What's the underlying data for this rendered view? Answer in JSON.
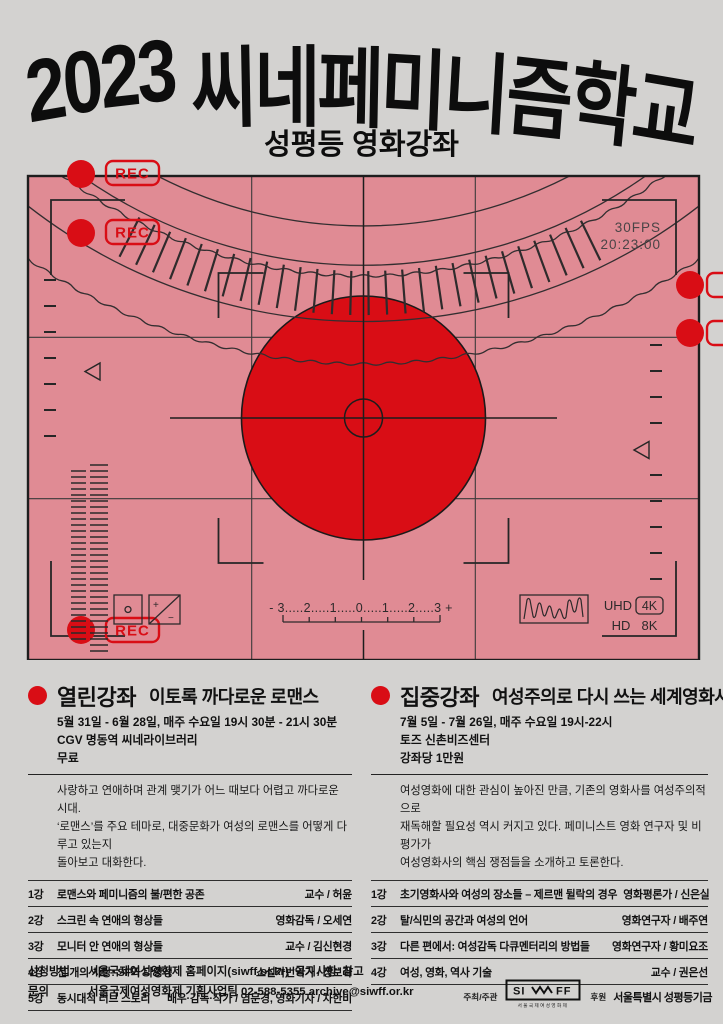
{
  "poster": {
    "title": "2023 씨네페미니즘학교",
    "subtitle": "성평등 영화강좌"
  },
  "viewfinder": {
    "rec_label": "REC",
    "fps": "30FPS",
    "timecode": "20:23:00",
    "scale_text": "- 3.....2.....1.....0.....1.....2.....3 +",
    "uhd_label": "UHD",
    "fourk_label": "4K",
    "hd_label": "HD",
    "eightk_label": "8K",
    "exposure_plus": "+",
    "exposure_minus": "−",
    "accent_red": "#d90d15",
    "panel_pink": "#e08b94"
  },
  "sections": [
    {
      "type": "열린강좌",
      "title": "이토록 까다로운 로맨스",
      "details": [
        "5월 31일 - 6월 28일, 매주 수요일 19시 30분 - 21시 30분",
        "CGV 명동역 씨네라이브러리",
        "무료"
      ],
      "description": "사랑하고 연애하며 관계 맺기가 어느 때보다 어렵고 까다로운 시대.\n‘로맨스’를 주요 테마로, 대중문화가 여성의 로맨스를 어떻게 다루고 있는지\n돌아보고 대화한다.",
      "lectures": [
        {
          "no": "1강",
          "title": "로맨스와 페미니즘의 불/편한 공존",
          "speaker": "교수 / 허윤"
        },
        {
          "no": "2강",
          "title": "스크린 속 연애의 형상들",
          "speaker": "영화감독 / 오세연"
        },
        {
          "no": "3강",
          "title": "모니터 안 연애의 형상들",
          "speaker": "교수 / 김신현경"
        },
        {
          "no": "4강",
          "title": "천 개의 사랑: SF와 다양성",
          "speaker": "소설가번역가 / 정보라"
        },
        {
          "no": "5강",
          "title": "동시대적 러브 스토리",
          "speaker": "배우·감독·작가 / 염문경, 영화기자 / 차한비"
        }
      ]
    },
    {
      "type": "집중강좌",
      "title": "여성주의로 다시 쓰는 세계영화사",
      "details": [
        "7월 5일 - 7월 26일, 매주 수요일 19시-22시",
        "토즈 신촌비즈센터",
        "강좌당 1만원"
      ],
      "description": "여성영화에 대한 관심이 높아진 만큼, 기존의 영화사를 여성주의적으로\n재독해할 필요성 역시 커지고 있다. 페미니스트 영화 연구자 및 비평가가\n여성영화사의 핵심 쟁점들을 소개하고 토론한다.",
      "lectures": [
        {
          "no": "1강",
          "title": "초기영화사와 여성의 장소들 – 제르맨 뒬락의 경우",
          "speaker": "영화평론가 / 신은실"
        },
        {
          "no": "2강",
          "title": "탈/식민의 공간과 여성의 언어",
          "speaker": "영화연구자 / 배주연"
        },
        {
          "no": "3강",
          "title": "다른 편에서: 여성감독 다큐멘터리의 방법들",
          "speaker": "영화연구자 / 황미요조"
        },
        {
          "no": "4강",
          "title": "여성, 영화, 역사 기술",
          "speaker": "교수 / 권은선"
        }
      ]
    }
  ],
  "footer": {
    "rows": [
      {
        "label": "신청방법",
        "text": "서울국제여성영화제 홈페이지(siwff.or.kr) ‘공지사항’ 참고"
      },
      {
        "label": "문의",
        "text": "서울국제여성영화제 기획사업팀  02-588-5355  archive@siwff.or.kr"
      }
    ],
    "host_label": "주최/주관",
    "logo_si": "SI",
    "logo_ff": "FF",
    "logo_caption": "서울국제여성영화제",
    "sponsor_label": "후원",
    "sponsor_name": "서울특별시 성평등기금"
  }
}
